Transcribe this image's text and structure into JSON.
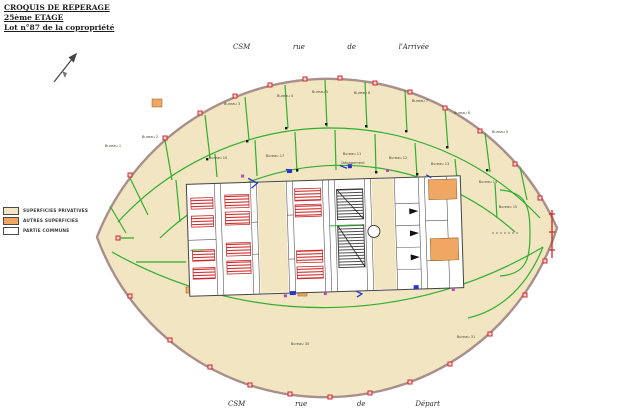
{
  "header": {
    "line1": "CROQUIS DE REPERAGE",
    "line2": "25ème ETAGE",
    "line3": "Lot n°87 de la copropriété"
  },
  "streets": {
    "top": {
      "words": [
        "CSM",
        "rue",
        "de",
        "l'Arrivée"
      ]
    },
    "bottom": {
      "words": [
        "CSM",
        "rue",
        "de",
        "Départ"
      ]
    }
  },
  "legend": {
    "items": [
      {
        "label": "SUPERFICIES PRIVATIVES",
        "color": "#f2e5c1"
      },
      {
        "label": "AUTRES SUPERFICIES",
        "color": "#efa763"
      },
      {
        "label": "PARTIE COMMUNE",
        "color": "#ffffff"
      }
    ]
  },
  "colors": {
    "private_fill": "#f2e5c1",
    "other_fill": "#efa763",
    "common_fill": "#ffffff",
    "partition_green": "#2fae2f",
    "marker_red": "#cc2a2a",
    "annotation_blue": "#2b35c8",
    "annotation_magenta": "#b44ab8",
    "facade": "#a98f8b"
  },
  "plan": {
    "rooms": [
      {
        "label": "Bureau 1",
        "x": 113,
        "y": 146
      },
      {
        "label": "Bureau 2",
        "x": 150,
        "y": 137
      },
      {
        "label": "Bureau 3",
        "x": 232,
        "y": 104
      },
      {
        "label": "Bureau 4",
        "x": 285,
        "y": 96
      },
      {
        "label": "Bureau 5",
        "x": 320,
        "y": 92
      },
      {
        "label": "Bureau 6",
        "x": 362,
        "y": 93
      },
      {
        "label": "Bureau 7",
        "x": 420,
        "y": 101
      },
      {
        "label": "Bureau 8",
        "x": 462,
        "y": 113
      },
      {
        "label": "Bureau 9",
        "x": 500,
        "y": 132
      },
      {
        "label": "Bureau 10",
        "x": 218,
        "y": 158
      },
      {
        "label": "Bureau 17",
        "x": 275,
        "y": 156
      },
      {
        "label": "Bureau 11",
        "x": 352,
        "y": 154
      },
      {
        "label": "Bureau 12",
        "x": 398,
        "y": 158
      },
      {
        "label": "Bureau 13",
        "x": 440,
        "y": 164
      },
      {
        "label": "Bureau 14",
        "x": 488,
        "y": 182
      },
      {
        "label": "Bureau 15",
        "x": 508,
        "y": 207
      },
      {
        "label": "Dégagement",
        "x": 353,
        "y": 163
      },
      {
        "label": "Bureau 30",
        "x": 300,
        "y": 344
      },
      {
        "label": "Bureau 31",
        "x": 466,
        "y": 337
      }
    ]
  }
}
